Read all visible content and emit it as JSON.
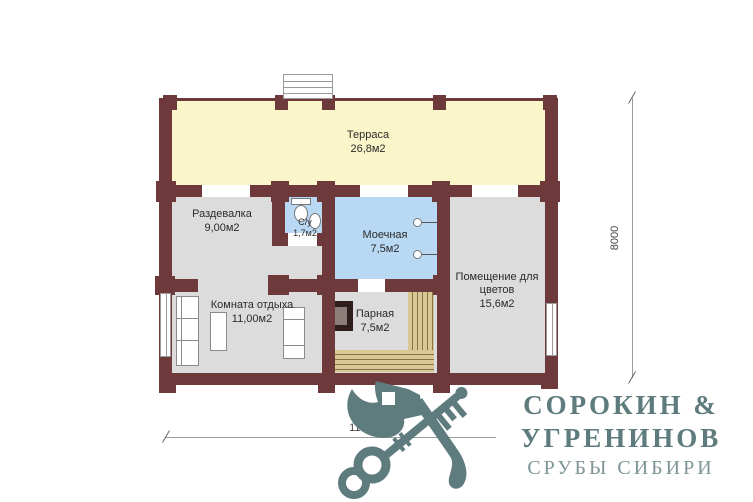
{
  "palette": {
    "wall": "#6e393a",
    "terrace_fill": "#faf6c9",
    "wet_room_fill": "#b9d8f3",
    "room_fill": "#dcdcdc",
    "bench_fill": "#d9c894",
    "bench_line": "#83744c",
    "logo_color": "#5e7b7e",
    "dimension_line": "#9b9b9b"
  },
  "rooms": {
    "terrace": {
      "name": "Терраса",
      "area": "26,8м2"
    },
    "changing_room": {
      "name": "Раздевалка",
      "area": "9,00м2"
    },
    "bathroom": {
      "name": "С/у",
      "area": "1,7м2"
    },
    "washing_room": {
      "name": "Моечная",
      "area": "7,5м2"
    },
    "flower_room": {
      "name": "Помещение для цветов",
      "area": "15,6м2"
    },
    "rest_room": {
      "name": "Комната отдыха",
      "area": "11,00м2"
    },
    "steam_room": {
      "name": "Парная",
      "area": "7,5м2"
    }
  },
  "dimensions": {
    "bottom": "11000",
    "right": "8000"
  },
  "logo": {
    "brand_line1": "СОРОКИН &",
    "brand_line2": "УГРЕНИНОВ",
    "tagline": "СРУБЫ СИБИРИ"
  }
}
